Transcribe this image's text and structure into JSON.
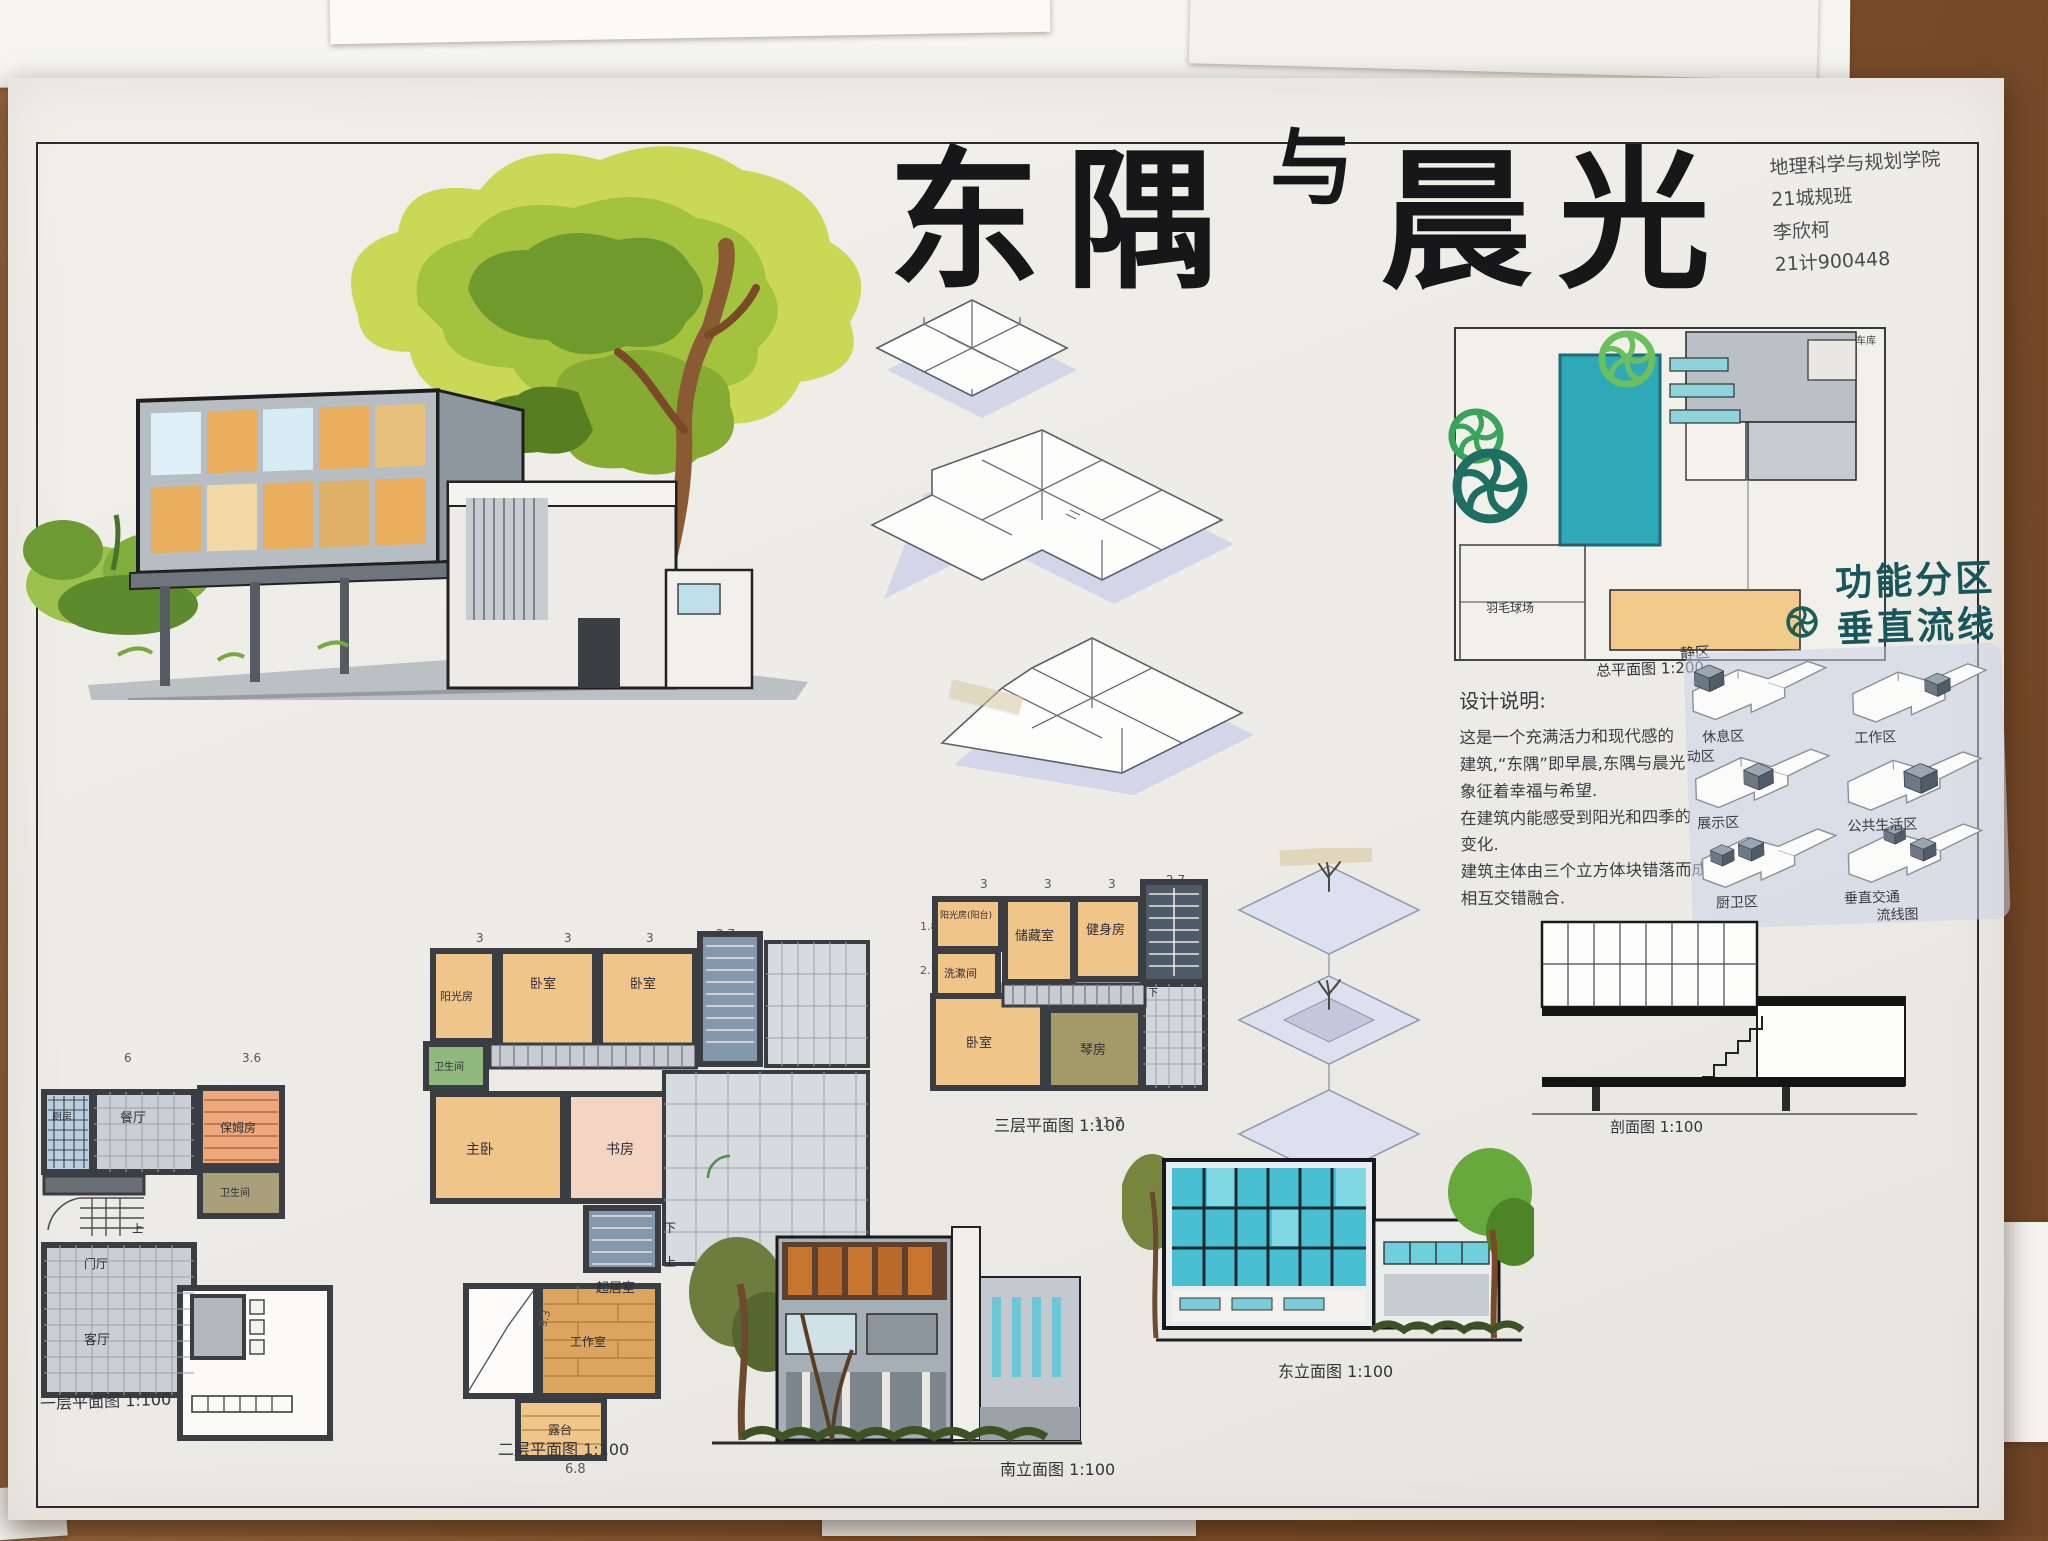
{
  "header": {
    "title_full": "东隅与晨光",
    "title_left": "东隅",
    "title_conj": "与",
    "title_right": "晨光",
    "credit_line1": "地理科学与规划学院",
    "credit_line2": "21城规班",
    "credit_line3": "李欣柯",
    "credit_line4": "21计900448"
  },
  "desk": {
    "note_fragment": "三层平面图"
  },
  "site_plan": {
    "label": "总平面图 1:200",
    "court": "羽毛球场",
    "garage": "车库"
  },
  "zones": {
    "heading1": "功能分区",
    "heading2": "垂直流线",
    "quiet": "静区",
    "rest": "休息区",
    "active": "动区",
    "work": "工作区",
    "display": "展示区",
    "public": "公共生活区",
    "kitchen_bath": "厨卫区",
    "vertical": "垂直交通",
    "flow": "流线图"
  },
  "notes": {
    "heading": "设计说明:",
    "l1": "这是一个充满活力和现代感的",
    "l2": "建筑,“东隅”即早晨,东隅与晨光",
    "l3": "象征着幸福与希望.",
    "l4": "在建筑内能感受到阳光和四季的",
    "l5": "变化.",
    "l6": "建筑主体由三个立方体块错落而成,",
    "l7": "相互交错融合."
  },
  "floor1": {
    "label": "一层平面图 1:100",
    "rooms": {
      "kitchen": "厨房",
      "dining": "餐厅",
      "nanny": "保姆房",
      "bath": "卫生间",
      "hall": "门厅",
      "living": "客厅"
    },
    "dims": {
      "d1": "6",
      "d2": "3.6"
    },
    "stair_up": "上"
  },
  "floor2": {
    "label": "二层平面图 1:100",
    "rooms": {
      "sun": "阳光房",
      "bed1": "卧室",
      "bed2": "卧室",
      "bath": "卫生间",
      "master": "主卧",
      "study": "书房",
      "living": "起居室",
      "work": "工作室",
      "terrace": "露台"
    },
    "dims": {
      "d1": "3",
      "d2": "3",
      "d3": "3",
      "d4": "2.7",
      "d5": "9.3",
      "d6": "6.8"
    },
    "up": "上",
    "down": "下"
  },
  "floor3": {
    "label": "三层平面图 1:100",
    "rooms": {
      "sun": "阳光房(阳台)",
      "storage": "储藏室",
      "gym": "健身房",
      "wash": "洗漱间",
      "bed": "卧室",
      "piano": "琴房"
    },
    "dims": {
      "d1": "3",
      "d2": "3",
      "d3": "3",
      "d4": "2.7",
      "d5": "1.8",
      "d6": "2.1",
      "d7": "11.7"
    },
    "down": "下"
  },
  "section": {
    "label": "剖面图 1:100"
  },
  "elevations": {
    "south": "南立面图 1:100",
    "east": "东立面图 1:100"
  },
  "colors": {
    "pool_teal": "#2fa9b8",
    "accent_teal": "#17565a",
    "tree_green": "#7ab62e",
    "plan_orange": "#f0c58a",
    "wall_dark": "#3a3d42",
    "periwinkle": "#ccd3e8"
  }
}
